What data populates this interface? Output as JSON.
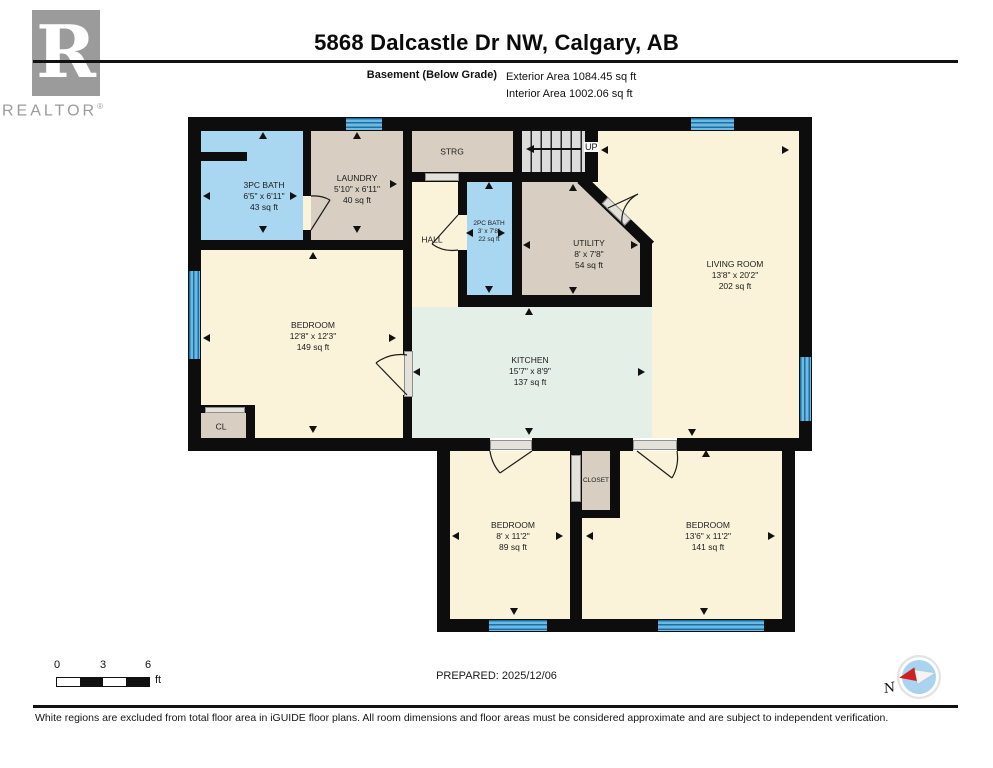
{
  "header": {
    "brand": "REALTOR",
    "brand_reg": "®",
    "logo_letter": "R",
    "title": "5868 Dalcastle Dr NW, Calgary, AB",
    "floor_label": "Basement (Below Grade)",
    "exterior_area": "Exterior Area 1084.45 sq ft",
    "interior_area": "Interior Area 1002.06 sq ft"
  },
  "rooms": {
    "bath3pc": {
      "name": "3PC BATH",
      "dims": "6'5\" x 6'11\"",
      "area": "43 sq ft"
    },
    "laundry": {
      "name": "LAUNDRY",
      "dims": "5'10\" x 6'11\"",
      "area": "40 sq ft"
    },
    "strg": {
      "name": "STRG"
    },
    "hall": {
      "name": "HALL"
    },
    "bath2pc": {
      "name": "2PC BATH",
      "dims": "3' x 7'8\"",
      "area": "22 sq ft"
    },
    "utility": {
      "name": "UTILITY",
      "dims": "8' x 7'8\"",
      "area": "54 sq ft"
    },
    "living": {
      "name": "LIVING ROOM",
      "dims": "13'8\" x 20'2\"",
      "area": "202 sq ft"
    },
    "bedroom_left": {
      "name": "BEDROOM",
      "dims": "12'8\" x 12'3\"",
      "area": "149 sq ft"
    },
    "cl": {
      "name": "CL"
    },
    "kitchen": {
      "name": "KITCHEN",
      "dims": "15'7\" x 8'9\"",
      "area": "137 sq ft"
    },
    "bedroom_mid": {
      "name": "BEDROOM",
      "dims": "8' x 11'2\"",
      "area": "89 sq ft"
    },
    "closet": {
      "name": "CLOSET"
    },
    "bedroom_right": {
      "name": "BEDROOM",
      "dims": "13'6\" x 11'2\"",
      "area": "141 sq ft"
    },
    "stairs": {
      "label": "UP"
    }
  },
  "footer": {
    "scale": {
      "n0": "0",
      "n3": "3",
      "n6": "6",
      "unit": "ft"
    },
    "prepared": "PREPARED: 2025/12/06",
    "compass_n": "N",
    "disclaimer": "White regions are excluded from total floor area in iGUIDE floor plans. All room dimensions and floor areas must be considered approximate and are subject to independent verification."
  },
  "colors": {
    "wall": "#0d0d0d",
    "room_cream": "#faf3d9",
    "room_tan": "#d8cec1",
    "room_blue": "#a9d7f1",
    "room_green": "#e4efe7",
    "window_blue": "#6cb9e4",
    "logo_gray": "#9b9b9b",
    "compass_red": "#cf2020"
  }
}
